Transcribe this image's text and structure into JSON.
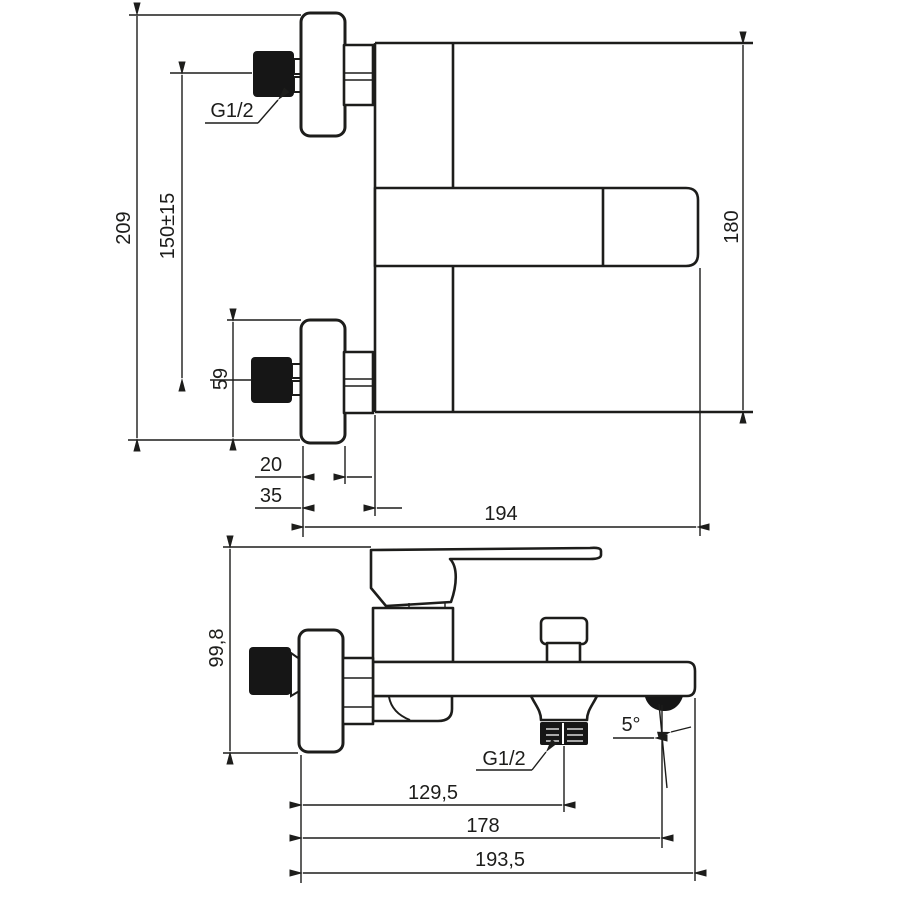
{
  "drawing": {
    "type": "technical dimension drawing",
    "subject": "wall-mounted bath shower mixer",
    "background": "#ffffff",
    "line_color": "#1d1d1b",
    "front": {
      "total_height": "209",
      "inlet_spacing": "150±15",
      "flange_height": "59",
      "flange_depth": "20",
      "wall_offset": "35",
      "projection": "194",
      "body_height": "180",
      "inlet_thread": "G1/2"
    },
    "top": {
      "height": "99,8",
      "outlet_offset": "129,5",
      "aerator_offset": "178",
      "total_projection": "193,5",
      "spout_angle": "5°",
      "outlet_thread": "G1/2"
    }
  }
}
